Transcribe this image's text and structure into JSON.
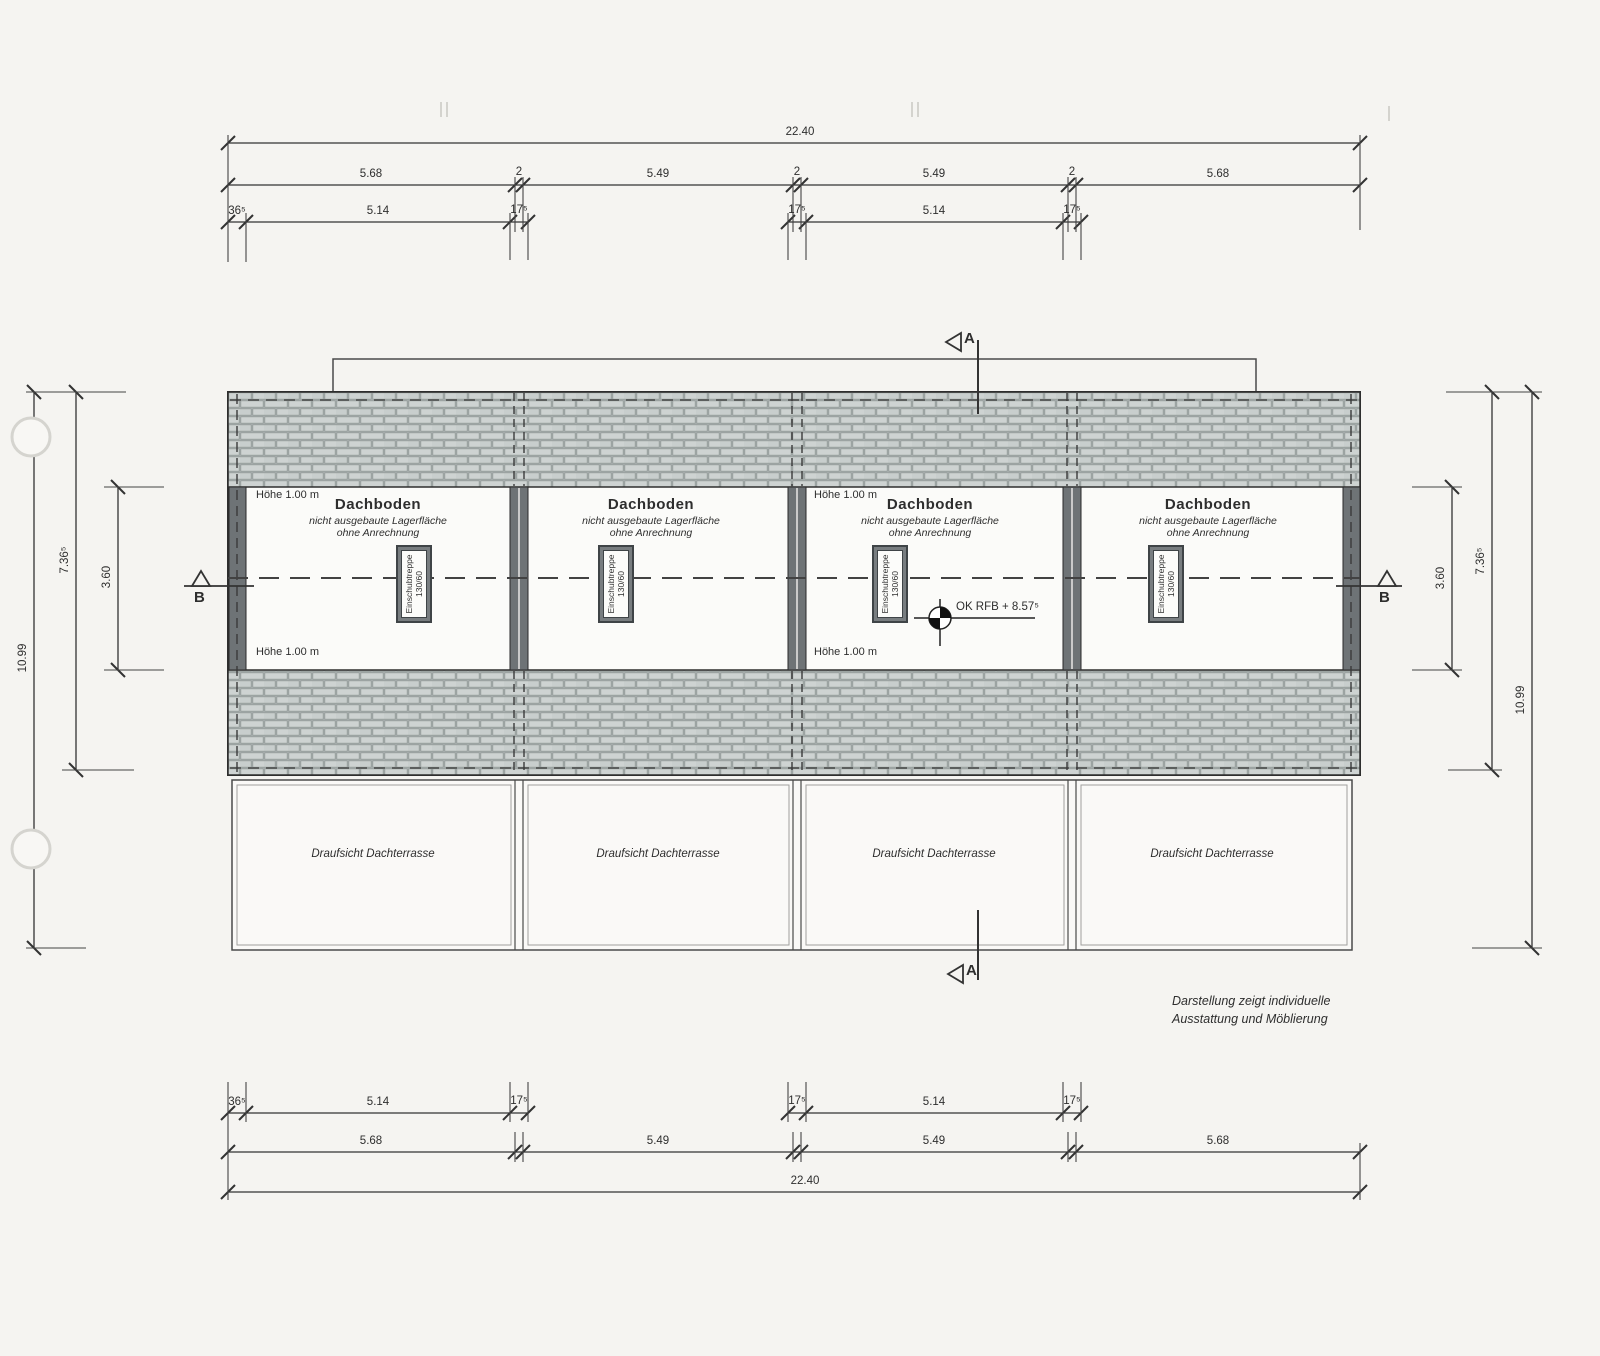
{
  "dims_top": {
    "total": "22.40",
    "row2": [
      "5.68",
      "2",
      "5.49",
      "2",
      "5.49",
      "2",
      "5.68"
    ],
    "row3": [
      "36⁵",
      "5.14",
      "17⁵",
      "17⁵",
      "5.14",
      "17⁵"
    ]
  },
  "dims_bottom": {
    "total": "22.40",
    "row2": [
      "5.68",
      "5.49",
      "5.49",
      "5.68"
    ],
    "row3": [
      "36⁵",
      "5.14",
      "17⁵",
      "17⁵",
      "5.14",
      "17⁵"
    ]
  },
  "dims_left": {
    "overall": "10.99",
    "building": "7.36⁵",
    "attic": "3.60"
  },
  "dims_right": {
    "attic": "3.60",
    "building": "7.36⁵",
    "overall": "10.99"
  },
  "sections": {
    "a": "A",
    "b": "B"
  },
  "level": {
    "label": "OK RFB + 8.57⁵"
  },
  "rooms": [
    {
      "title": "Dachboden",
      "subtitle1": "nicht ausgebaute Lagerfläche",
      "subtitle2": "ohne Anrechnung",
      "stair_label1": "Einschubtreppe",
      "stair_label2": "130/60",
      "height_note_top": "Höhe 1.00 m",
      "height_note_bottom": "Höhe 1.00 m"
    },
    {
      "title": "Dachboden",
      "subtitle1": "nicht ausgebaute Lagerfläche",
      "subtitle2": "ohne Anrechnung",
      "stair_label1": "Einschubtreppe",
      "stair_label2": "130/60"
    },
    {
      "title": "Dachboden",
      "subtitle1": "nicht ausgebaute Lagerfläche",
      "subtitle2": "ohne Anrechnung",
      "stair_label1": "Einschubtreppe",
      "stair_label2": "130/60",
      "height_note_top": "Höhe 1.00 m",
      "height_note_bottom": "Höhe 1.00 m"
    },
    {
      "title": "Dachboden",
      "subtitle1": "nicht ausgebaute Lagerfläche",
      "subtitle2": "ohne Anrechnung",
      "stair_label1": "Einschubtreppe",
      "stair_label2": "130/60"
    }
  ],
  "terraces": [
    {
      "label": "Draufsicht Dachterrasse"
    },
    {
      "label": "Draufsicht Dachterrasse"
    },
    {
      "label": "Draufsicht Dachterrasse"
    },
    {
      "label": "Draufsicht Dachterrasse"
    }
  ],
  "note": {
    "line1": "Darstellung zeigt individuelle",
    "line2": "Ausstattung und Möblierung"
  },
  "colors": {
    "paper": "#f5f4f1",
    "ink": "#333333",
    "roof_fill": "#ccd1d0",
    "roof_joint": "#939a99",
    "wall_fill": "#6e7376"
  }
}
